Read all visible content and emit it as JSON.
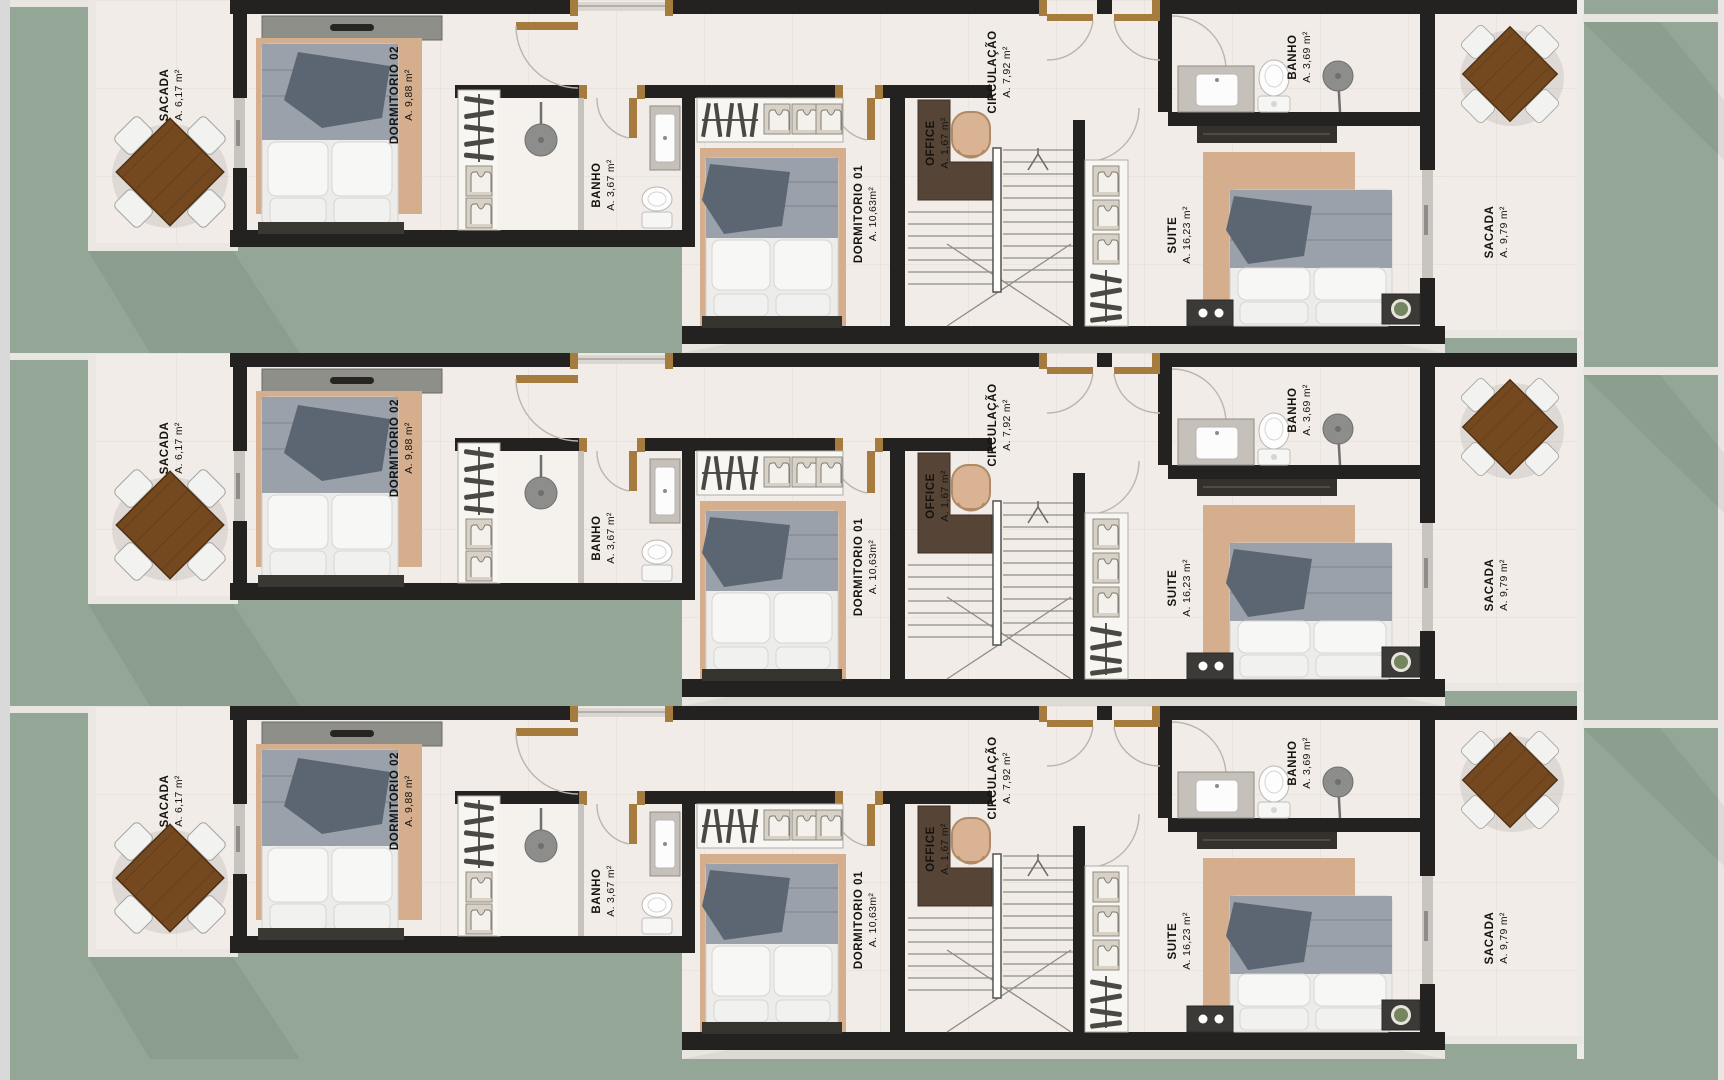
{
  "title": "Residential townhouse upper-floor plan, three identical units",
  "unit": {
    "rooms": {
      "sacada_left": {
        "name": "SACADA",
        "area": "A. 6,17 m²"
      },
      "dormitorio_02": {
        "name": "DORMITORIO 02",
        "area": "A. 9,88 m²"
      },
      "banho": {
        "name": "BANHO",
        "area": "A. 3,67 m²"
      },
      "dormitorio_01": {
        "name": "DORMITORIO 01",
        "area": "A. 10,63m²"
      },
      "office": {
        "name": "OFFICE",
        "area": "A. 1,67 m²"
      },
      "circulacao": {
        "name": "CIRCULAÇÃO",
        "area": "A. 7,92 m²"
      },
      "banho_suite": {
        "name": "BANHO",
        "area": "A. 3,69 m²"
      },
      "suite": {
        "name": "SUITE",
        "area": "A. 16,23 m²"
      },
      "sacada_right": {
        "name": "SACADA",
        "area": "A. 9,79 m²"
      }
    }
  },
  "floors": [
    {
      "id": "unit-1"
    },
    {
      "id": "unit-2"
    },
    {
      "id": "unit-3"
    }
  ],
  "colors": {
    "grass": "#94a796",
    "floor": "#f2ece8",
    "wall": "#242220",
    "rug": "#d5ae8e",
    "duvet": "#9aa1aa",
    "throw": "#5c6672",
    "wood_table": "#74491f",
    "office_desk": "#564537",
    "door_wood": "#a67b3e",
    "label_text": "#15130f"
  }
}
